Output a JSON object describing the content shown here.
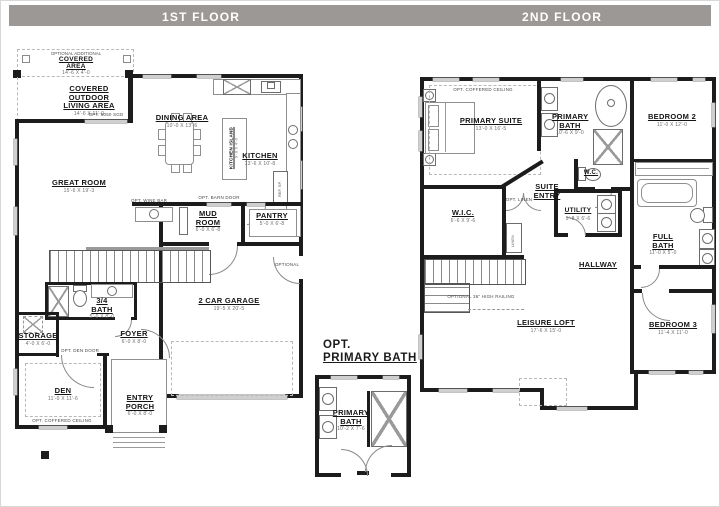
{
  "header": {
    "floor1_label": "1ST FLOOR",
    "floor2_label": "2ND FLOOR"
  },
  "colors": {
    "header_bar": "#9b9896",
    "wall": "#1c1c1c",
    "window": "#cfcfcf"
  },
  "floor1": {
    "opt_covered_area": {
      "pre": "OPTIONAL ADDITIONAL",
      "label": "COVERED AREA",
      "dim": "14'-6 X 4'-0"
    },
    "covered_outdoor": {
      "label": "COVERED OUTDOOR LIVING AREA",
      "dim": "14'-6 X 11'-0"
    },
    "opt_sgd": "OPT. 6050 SGD",
    "great_room": {
      "label": "GREAT ROOM",
      "dim": "15'-6 X 19'-3"
    },
    "dining": {
      "label": "DINING AREA",
      "dim": "10'-0 X 13'-6"
    },
    "kitchen": {
      "label": "KITCHEN",
      "dim": "13'-6 X 10'-8"
    },
    "island": {
      "label": "KITCHEN ISLAND",
      "dim": "9'-0 X 4'-0"
    },
    "ref_label": "REF. SP.",
    "opt_barn_door": "OPT. BARN DOOR",
    "opt_wine_bar": "OPT. WINE BAR",
    "mud_room": {
      "label": "MUD ROOM",
      "dim": "6'-0 X 6'-8"
    },
    "pantry": {
      "label": "PANTRY",
      "dim": "5'-0 X 6'-8"
    },
    "bath": {
      "label": "3/4 BATH",
      "dim": "5'-0 X 8'-0"
    },
    "storage": {
      "label": "STORAGE",
      "dim": "4'-0 X 6'-0"
    },
    "foyer": {
      "label": "FOYER",
      "dim": "6'-0 X 8'-0"
    },
    "opt_den_door": "OPT. DEN DOOR",
    "den": {
      "label": "DEN",
      "dim": "11'-0 X 11'-6",
      "note": "OPT. COFFERED CEILING"
    },
    "entry_porch": {
      "label": "ENTRY PORCH",
      "dim": "6'-0 X 8'-0"
    },
    "garage": {
      "label": "2 CAR GARAGE",
      "dim": "19'-5 X 20'-5"
    },
    "optional_door": "OPTIONAL"
  },
  "floor2": {
    "primary_suite": {
      "label": "PRIMARY SUITE",
      "dim": "13'-0 X 16'-5",
      "note": "OPT. COFFERED CEILING"
    },
    "primary_bath": {
      "label": "PRIMARY BATH",
      "dim": "10'-6 X 9'-0"
    },
    "bedroom2": {
      "label": "BEDROOM 2",
      "dim": "11'-0 X 12'-0"
    },
    "wic": {
      "label": "W.I.C.",
      "dim": "6'-6 X 9'-6"
    },
    "suite_entry": {
      "label": "SUITE ENTRY"
    },
    "opt_linen": "OPT. LINEN",
    "linen": "LINEN",
    "wc": {
      "label": "W.C."
    },
    "utility": {
      "label": "UTILITY",
      "dim": "5'-8 X 6'-6"
    },
    "full_bath": {
      "label": "FULL BATH",
      "dim": "11'-0 X 5'-0"
    },
    "hallway": {
      "label": "HALLWAY"
    },
    "leisure_loft": {
      "label": "LEISURE LOFT",
      "dim": "17'-6 X 15'-0"
    },
    "bedroom3": {
      "label": "BEDROOM 3",
      "dim": "11'-4 X 11'-0"
    },
    "railing_note": "OPTIONAL 36\" HIGH RAILING"
  },
  "opt_primary_bath": {
    "title_line1": "OPT.",
    "title_line2": "PRIMARY BATH",
    "room": {
      "label": "PRIMARY BATH",
      "dim": "10'-2 X 7'-6"
    }
  }
}
